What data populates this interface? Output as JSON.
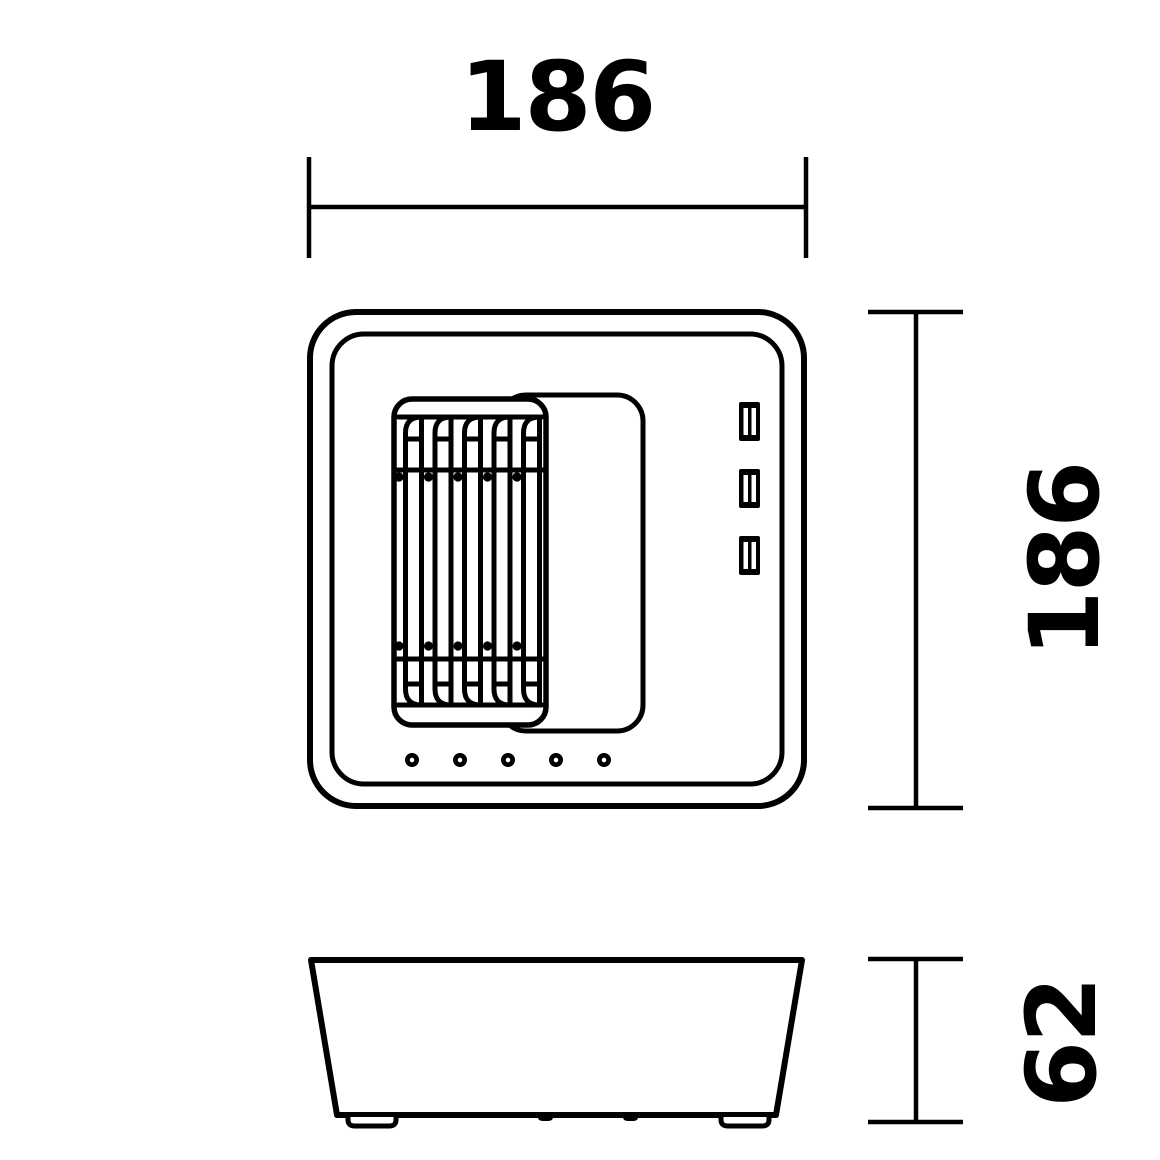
{
  "drawing": {
    "background_color": "#ffffff",
    "line_color": "#000000",
    "dimensions": {
      "width": {
        "value": "186"
      },
      "height": {
        "value": "186"
      },
      "depth": {
        "value": "62"
      }
    },
    "front_view": {
      "grille": {
        "slat_count": 5,
        "rivet_rows": 2,
        "rivets_per_row": 5
      },
      "ports": {
        "count": 3
      },
      "leds": {
        "count": 5
      }
    },
    "side_view": {
      "feet_count": 2,
      "bump_count": 2
    }
  }
}
